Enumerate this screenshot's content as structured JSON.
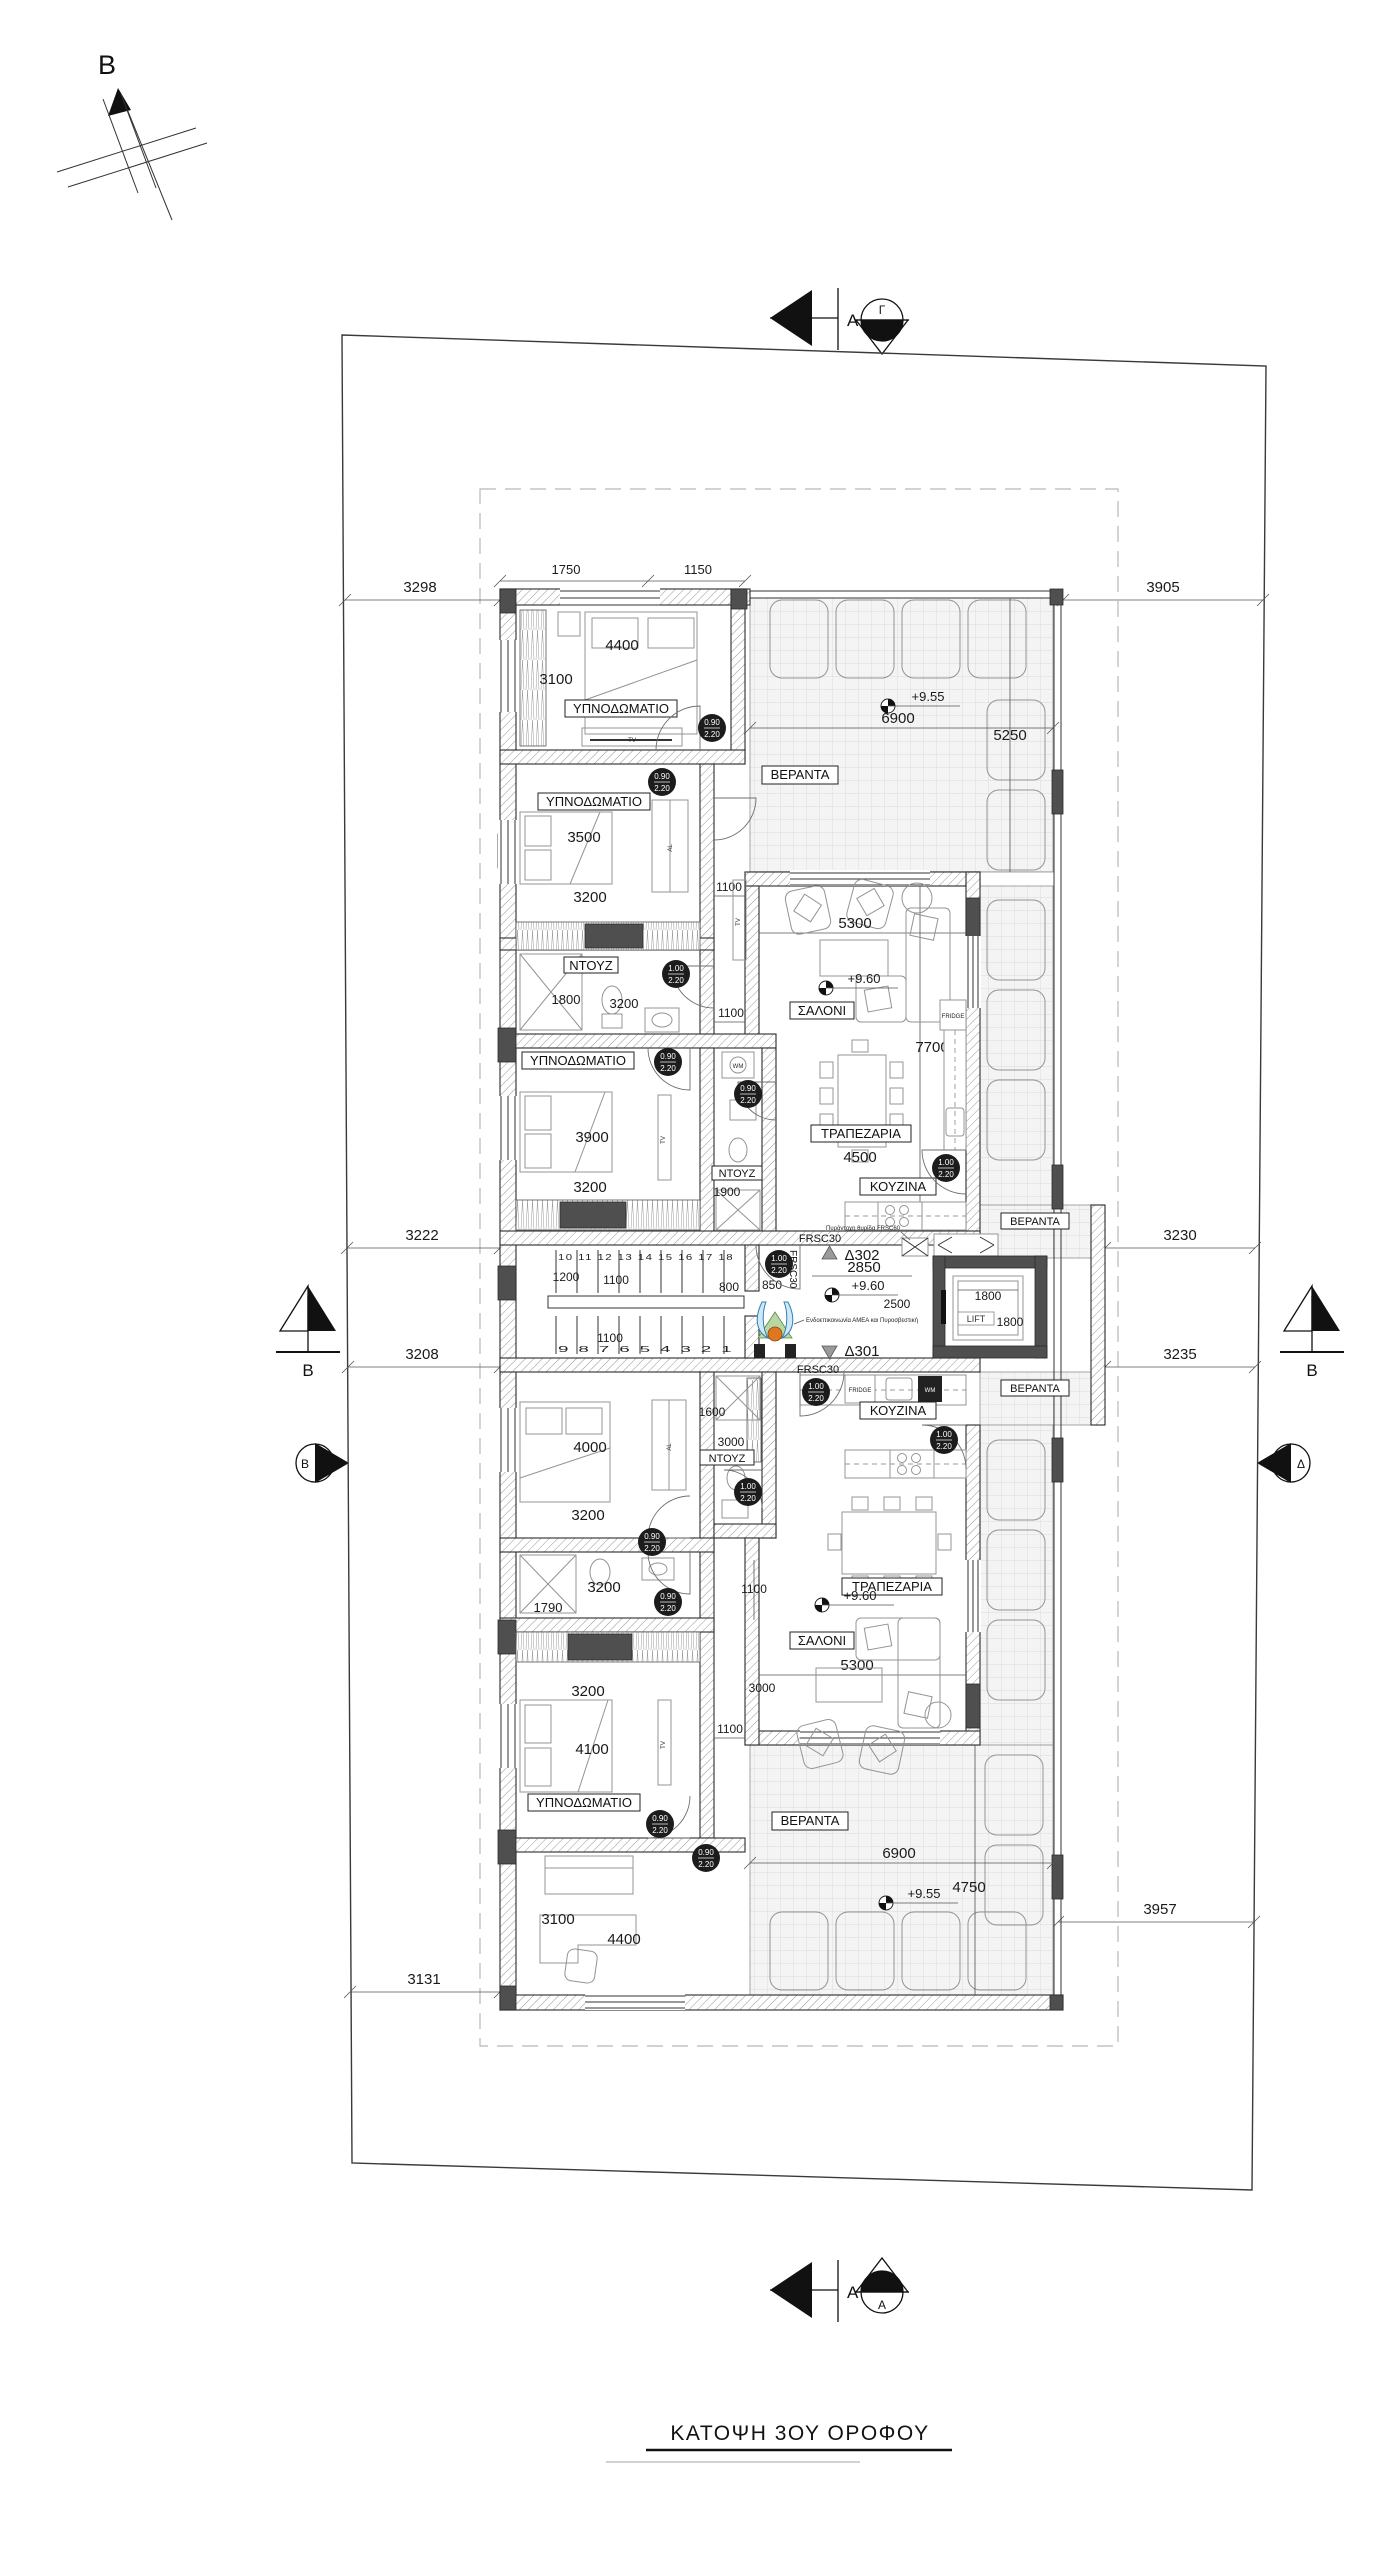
{
  "t": {
    "title": "ΚΑΤΟΨΗ 3ΟΥ ΟΡΟΦΟΥ",
    "north": "B"
  },
  "m": {
    "top_s": "A",
    "top_c": "Γ",
    "bot_s": "A",
    "bot_c": "A",
    "left_s": "B",
    "left_c": "B",
    "right_s": "B",
    "right_c": "Δ"
  },
  "site": {
    "nw": "3298",
    "ne": "3905",
    "wu": "3222",
    "wl": "3208",
    "eu": "3230",
    "el": "3235",
    "sw": "3131",
    "se": "3957"
  },
  "u": {
    "bed1_label": "ΥΠΝΟΔΩΜΑΤΙΟ",
    "bed1_w": "4400",
    "bed1_h": "3100",
    "bed1_t1": "1750",
    "bed1_t2": "1150",
    "bed1_tv": "TV",
    "bed2_label": "ΥΠΝΟΔΩΜΑΤΙΟ",
    "bed2_w": "3500",
    "bed2_h": "3200",
    "bed2_al": "AL",
    "bed2_tv": "TV",
    "bed2_side": "1100",
    "sh1_label": "ΝΤΟΥΖ",
    "sh1_w": "1800",
    "sh1_h": "3200",
    "bed3_label": "ΥΠΝΟΔΩΜΑΤΙΟ",
    "bed3_w": "3900",
    "bed3_h": "3200",
    "bed3_tv": "TV",
    "bed3_wm": "WM",
    "sh2_label": "ΝΤΟΥΖ",
    "sh2_d": "1900",
    "hall": "1100",
    "liv_label": "ΣΑΛΟΝΙ",
    "liv_w": "5300",
    "liv_lvl": "+9.60",
    "liv_h": "7700",
    "din_label": "ΤΡΑΠΕΖΑΡΙΑ",
    "din_w": "4500",
    "kit_label": "ΚΟΥΖΙΝΑ",
    "kit_fridge": "FRIDGE",
    "ver_label": "ΒΕΡΑΝΤΑ",
    "ver_lvl": "+9.55",
    "ver_w": "6900",
    "ver_d": "5250",
    "ver_side_label": "ΒΕΡΑΝΤΑ"
  },
  "c": {
    "s1": "1200",
    "s2": "1100",
    "s3": "1100",
    "s4": "800",
    "s5": "850",
    "steps_up": "10 11 12 13 14 15 16 17 18",
    "steps_dn": "9 8 7 6 5 4 3 2 1",
    "frsc_a": "FRSC30",
    "frsc_b": "FRSC30",
    "frsc_c": "FRSC30",
    "d302": "Δ302",
    "d301": "Δ301",
    "w": "2850",
    "lvl": "+9.60",
    "d": "2500",
    "lift": "LIFT",
    "lift_w": "1800",
    "lift_d": "1800",
    "note_fire": "Πυράντοχη θυρίδα FRSC60",
    "note_amea": "Ενδοεπικοινωνία ΑΜΕΑ και Πυροσβεστική"
  },
  "l": {
    "kit_label": "ΚΟΥΖΙΝΑ",
    "kit_fridge": "FRIDGE",
    "wm": "WM",
    "sh1_label": "ΝΤΟΥΖ",
    "sh1_w": "1600",
    "sh1_h": "3000",
    "bed1_w": "4000",
    "bed1_h": "3200",
    "bed1_al": "AL",
    "bath_w": "3200",
    "bath_h": "1790",
    "bed2_label": "ΥΠΝΟΔΩΜΑΤΙΟ",
    "bed2_t": "3200",
    "bed2_w": "4100",
    "bed2_tv": "TV",
    "bed2_side": "1100",
    "off_h": "3100",
    "off_w": "4400",
    "liv_label": "ΣΑΛΟΝΙ",
    "liv_w": "5300",
    "liv_lvl": "+9.60",
    "liv_a": "3000",
    "liv_b": "1100",
    "din_label": "ΤΡΑΠΕΖΑΡΙΑ",
    "ver_label": "ΒΕΡΑΝΤΑ",
    "ver_lvl": "+9.55",
    "ver_w": "6900",
    "ver_d": "4750",
    "ver_side_label": "ΒΕΡΑΝΤΑ"
  },
  "d": {
    "nw": "0.90",
    "nh": "2.20",
    "ww": "1.00",
    "wh": "2.20"
  }
}
